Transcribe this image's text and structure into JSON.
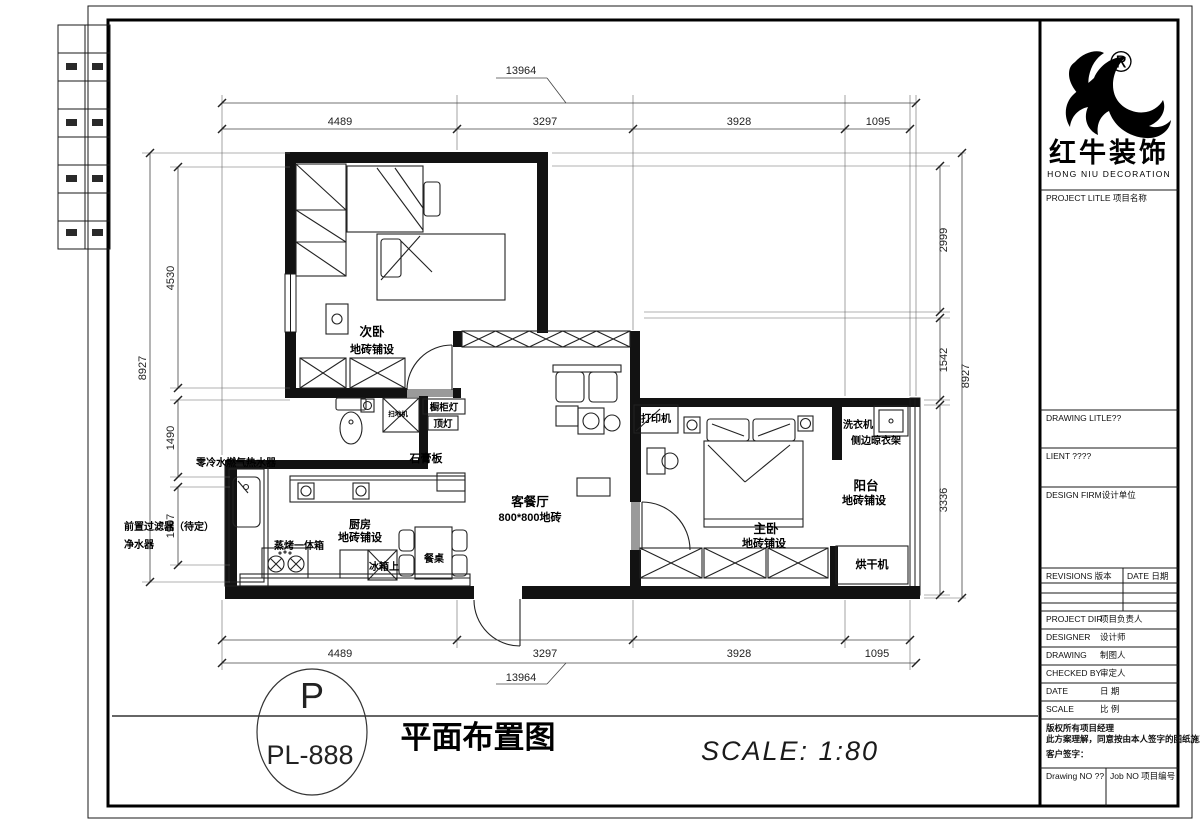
{
  "logo": {
    "reg": "®",
    "name": "红牛装饰",
    "sub": "HONG NIU DECORATION"
  },
  "title_block": {
    "project": "PROJECT LITLE  项目名称",
    "drawing_title": "DRAWING LITLE??",
    "client": "LIENT ????",
    "firm": "DESIGN FIRM设计单位",
    "revisions": "REVISIONS  版本",
    "date_hdr": "DATE  日期",
    "rows": [
      {
        "en": "PROJECT DIR",
        "cn": "项目负责人"
      },
      {
        "en": "DESIGNER",
        "cn": "设计师"
      },
      {
        "en": "DRAWING",
        "cn": "制图人"
      },
      {
        "en": "CHECKED BY",
        "cn": "审定人"
      },
      {
        "en": "DATE",
        "cn": "日 期"
      },
      {
        "en": "SCALE",
        "cn": "比 例"
      }
    ],
    "note1": "版权所有项目经理",
    "note2": "此方案理解，同意按由本人签字的图纸施工；",
    "note3": "客户签字：",
    "drawing_no": "Drawing NO ??",
    "job_no": "Job NO 项目编号"
  },
  "footer": {
    "letter": "P",
    "code": "PL-888",
    "title": "平面布置图",
    "scale": "SCALE:  1:80"
  },
  "dims": {
    "top_overall": "13964",
    "top": [
      "4489",
      "3297",
      "3928",
      "1095"
    ],
    "bottom_overall": "13964",
    "bottom": [
      "4489",
      "3297",
      "3928",
      "1095"
    ],
    "left_overall": "8927",
    "left": [
      "4530",
      "1490",
      "1907"
    ],
    "right": [
      "2999",
      "1542",
      "3336"
    ],
    "right_overall": "8927"
  },
  "labels": {
    "bedroom2": "次卧",
    "bedroom2_floor": "地砖铺设",
    "living": "客餐厅",
    "living_floor": "800*800地砖",
    "master": "主卧",
    "master_floor": "地砖铺设",
    "kitchen": "厨房",
    "kitchen_floor": "地砖铺设",
    "balcony": "阳台",
    "balcony_floor": "地砖铺设",
    "gypsum": "石膏板",
    "dining_table": "餐桌",
    "fridge": "冰箱上",
    "steam_oven": "蒸烤一体箱",
    "water_heater": "零冷水燃气热水器",
    "prefilter": "前置过滤器（待定）",
    "purifier": "净水器",
    "printer": "打印机",
    "washer": "洗衣机",
    "drying_rack": "侧边晾衣架",
    "dryer": "烘干机",
    "cabinet_light": "橱柜灯",
    "ceiling_light": "顶灯",
    "vacuum": "扫地机"
  }
}
